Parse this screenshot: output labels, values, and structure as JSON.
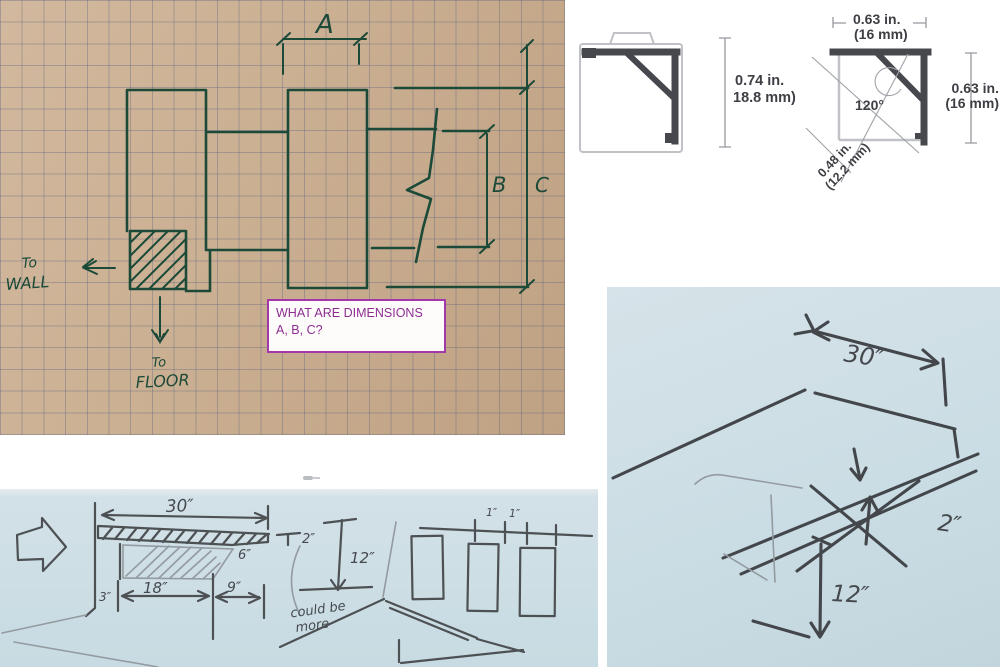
{
  "colors": {
    "graph_paper": "#cbaf92",
    "pen_green": "#1c4a38",
    "annotation_purple": "#a438a8",
    "blue_paper": "#cbdde4",
    "pencil_gray": "#45494d",
    "cad_dark": "#47484d"
  },
  "annotation_box": {
    "line1": "WHAT ARE DIMENSIONS",
    "line2": "A, B, C?"
  },
  "graph_sketch": {
    "dim_a": "A",
    "dim_b": "B",
    "dim_c": "C",
    "to_wall_line1": "To",
    "to_wall_line2": "WALL",
    "to_floor_line1": "To",
    "to_floor_line2": "FLOOR"
  },
  "profile_left": {
    "dim_in": "0.74 in.",
    "dim_mm": "18.8 mm)"
  },
  "profile_right": {
    "top_dim_in": "0.63 in.",
    "top_dim_mm": "(16 mm)",
    "angle": "120°",
    "diag_dim_in": "0.48 in.",
    "diag_dim_mm": "(12.2 mm)",
    "right_dim_in": "0.63 in.",
    "right_dim_mm": "(16 mm)"
  },
  "blue_sketch_left": {
    "width": "30″",
    "thickness": "2″",
    "height": "12″",
    "overhang": "6″",
    "wall_gap": "3″",
    "depth": "18″",
    "back_depth": "9″",
    "slat_a": "1″",
    "slat_b": "1″",
    "note_line1": "could be",
    "note_line2": "more"
  },
  "blue_sketch_right": {
    "width": "30″",
    "thickness": "2″",
    "height": "12″"
  }
}
